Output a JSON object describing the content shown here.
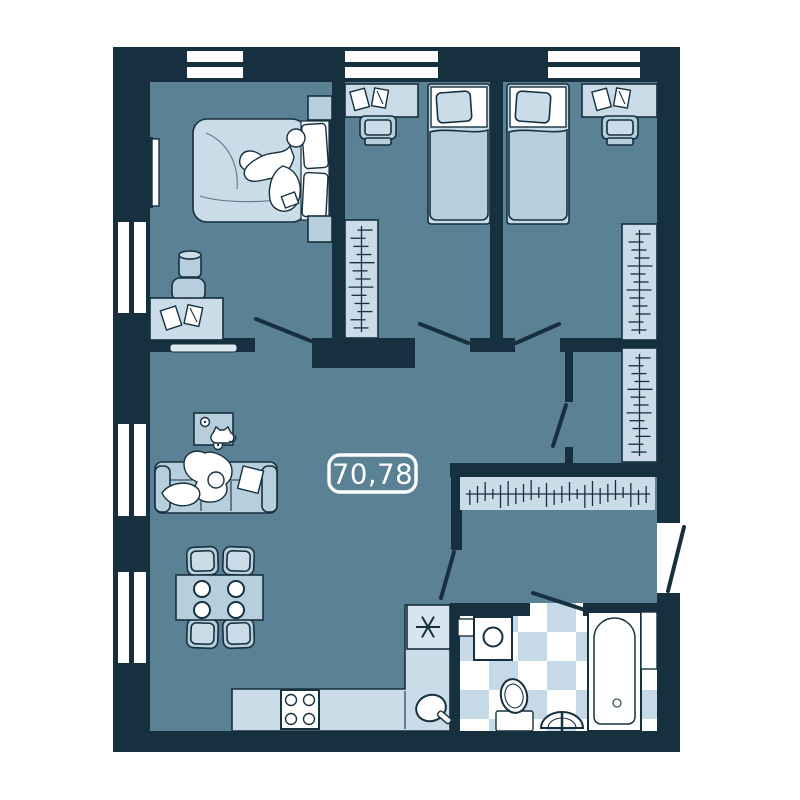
{
  "plan": {
    "area_label": "70,78"
  },
  "colors": {
    "wall": "#17303f",
    "floor": "#5b8194",
    "furn": "#b7cfdd",
    "furn2": "#c9dce8",
    "furn3": "#d8e5ee",
    "tile": "#c6d9e6",
    "white": "#ffffff",
    "label": "#ffffff"
  },
  "icons": {
    "fridge": "snowflake-icon"
  }
}
